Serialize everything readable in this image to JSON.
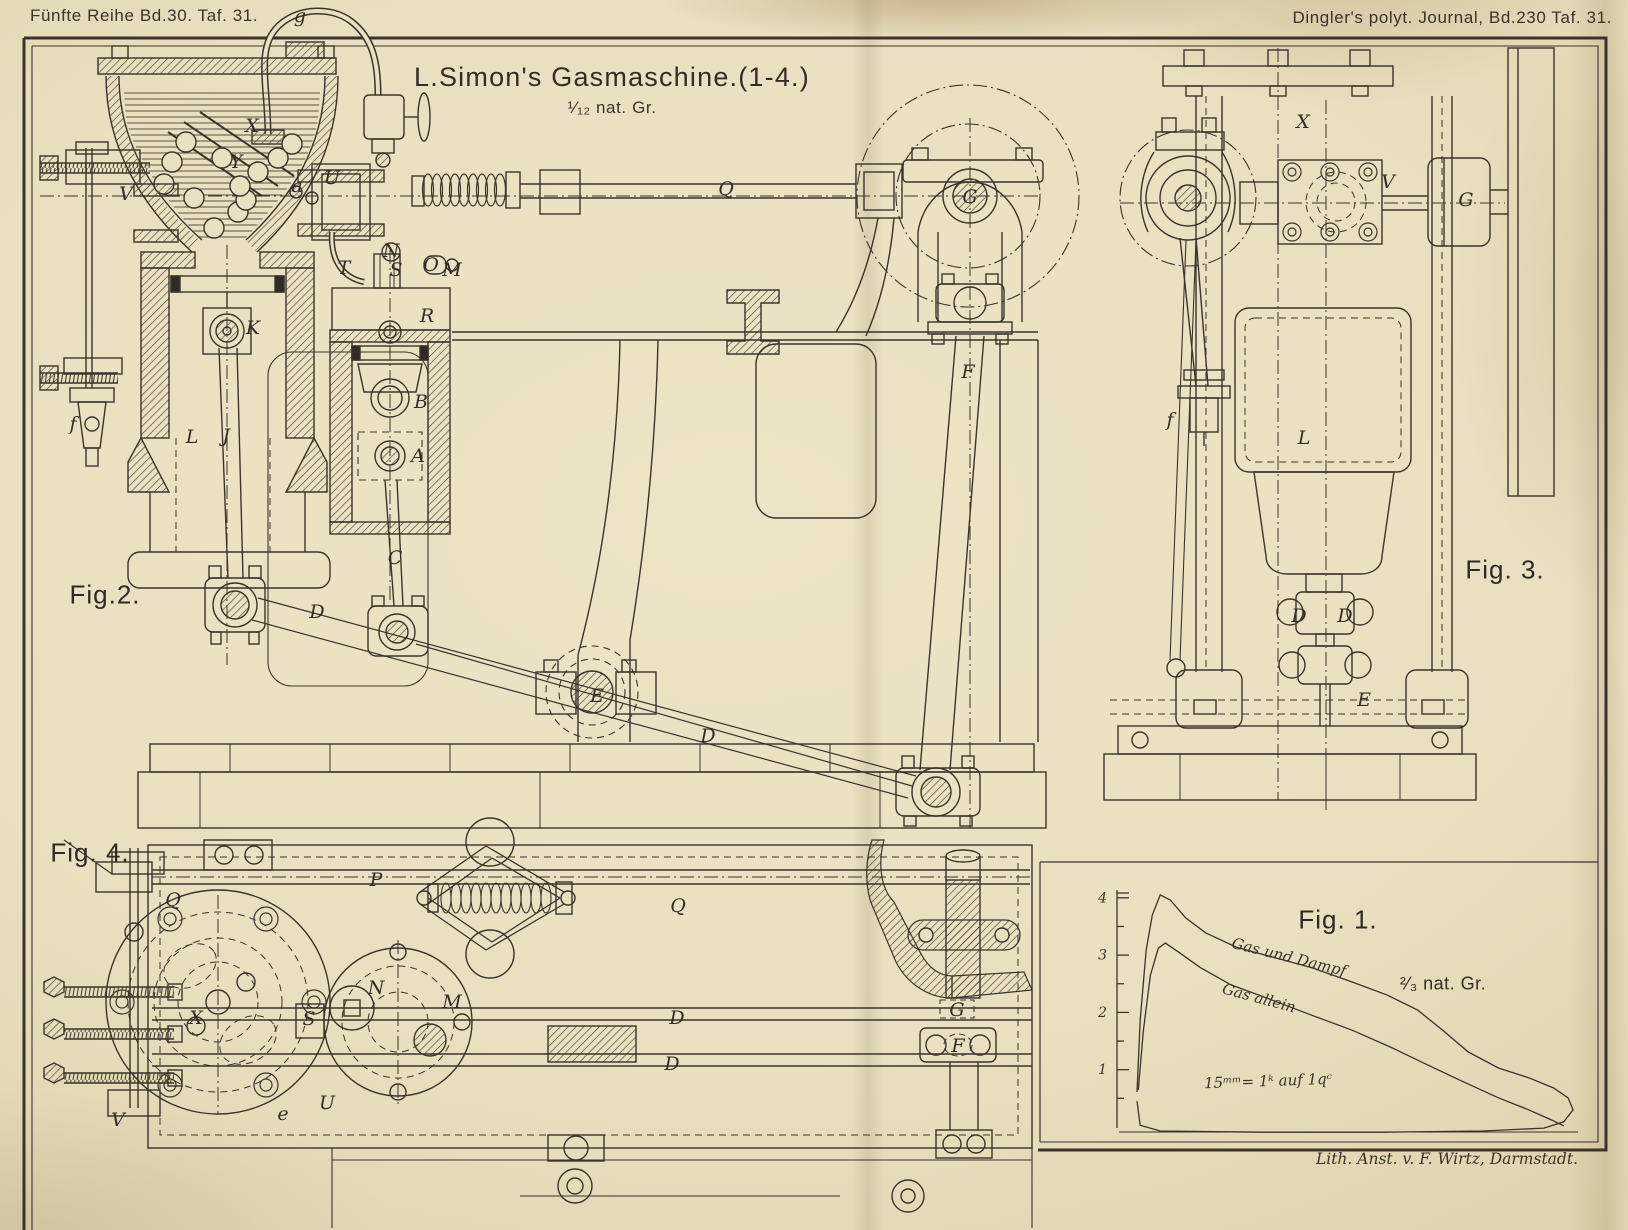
{
  "plate": {
    "header_left": "Fünfte Reihe Bd.30. Taf. 31.",
    "header_right": "Dingler's polyt. Journal, Bd.230 Taf. 31.",
    "title": "L.Simon's Gasmaschine.(1-4.)",
    "title_scale": "¹⁄₁₂ nat. Gr.",
    "credit": "Lith. Anst. v. F. Wirtz, Darmstadt.",
    "ink_color": "#3a3429",
    "paper_color": "#e8e0c0"
  },
  "figures": [
    {
      "id": "fig1",
      "label": "Fig. 1.",
      "x": 1338,
      "y": 920
    },
    {
      "id": "fig2",
      "label": "Fig.2.",
      "x": 105,
      "y": 595
    },
    {
      "id": "fig3",
      "label": "Fig. 3.",
      "x": 1505,
      "y": 570
    },
    {
      "id": "fig4",
      "label": "Fig. 4.",
      "x": 90,
      "y": 853
    }
  ],
  "part_labels": [
    {
      "fig": "fig2",
      "t": "g",
      "x": 300,
      "y": 16
    },
    {
      "fig": "fig2",
      "t": "X",
      "x": 252,
      "y": 126
    },
    {
      "fig": "fig2",
      "t": "Y",
      "x": 236,
      "y": 162
    },
    {
      "fig": "fig2",
      "t": "V",
      "x": 126,
      "y": 194
    },
    {
      "fig": "fig2",
      "t": "a",
      "x": 297,
      "y": 186
    },
    {
      "fig": "fig2",
      "t": "U",
      "x": 332,
      "y": 178
    },
    {
      "fig": "fig2",
      "t": "T",
      "x": 344,
      "y": 268
    },
    {
      "fig": "fig2",
      "t": "N",
      "x": 391,
      "y": 251
    },
    {
      "fig": "fig2",
      "t": "S",
      "x": 396,
      "y": 270
    },
    {
      "fig": "fig2",
      "t": "O",
      "x": 431,
      "y": 265
    },
    {
      "fig": "fig2",
      "t": "M",
      "x": 452,
      "y": 270
    },
    {
      "fig": "fig2",
      "t": "R",
      "x": 427,
      "y": 316
    },
    {
      "fig": "fig2",
      "t": "K",
      "x": 253,
      "y": 328
    },
    {
      "fig": "fig2",
      "t": "L",
      "x": 192,
      "y": 437
    },
    {
      "fig": "fig2",
      "t": "J",
      "x": 226,
      "y": 436
    },
    {
      "fig": "fig2",
      "t": "f",
      "x": 73,
      "y": 424
    },
    {
      "fig": "fig2",
      "t": "B",
      "x": 421,
      "y": 402
    },
    {
      "fig": "fig2",
      "t": "A",
      "x": 418,
      "y": 456
    },
    {
      "fig": "fig2",
      "t": "C",
      "x": 395,
      "y": 558
    },
    {
      "fig": "fig2",
      "t": "D",
      "x": 317,
      "y": 612
    },
    {
      "fig": "fig2",
      "t": "Q",
      "x": 726,
      "y": 189
    },
    {
      "fig": "fig2",
      "t": "G",
      "x": 970,
      "y": 197
    },
    {
      "fig": "fig2",
      "t": "F",
      "x": 968,
      "y": 372
    },
    {
      "fig": "fig2",
      "t": "D",
      "x": 708,
      "y": 736
    },
    {
      "fig": "fig2",
      "t": "E",
      "x": 597,
      "y": 696
    },
    {
      "fig": "fig3",
      "t": "X",
      "x": 1303,
      "y": 122
    },
    {
      "fig": "fig3",
      "t": "V",
      "x": 1388,
      "y": 182
    },
    {
      "fig": "fig3",
      "t": "G",
      "x": 1466,
      "y": 200
    },
    {
      "fig": "fig3",
      "t": "f",
      "x": 1170,
      "y": 420
    },
    {
      "fig": "fig3",
      "t": "L",
      "x": 1304,
      "y": 438
    },
    {
      "fig": "fig3",
      "t": "D",
      "x": 1299,
      "y": 616
    },
    {
      "fig": "fig3",
      "t": "D",
      "x": 1345,
      "y": 616
    },
    {
      "fig": "fig3",
      "t": "E",
      "x": 1364,
      "y": 700
    },
    {
      "fig": "fig4",
      "t": "P",
      "x": 376,
      "y": 880
    },
    {
      "fig": "fig4",
      "t": "Q",
      "x": 173,
      "y": 900
    },
    {
      "fig": "fig4",
      "t": "Q",
      "x": 678,
      "y": 906
    },
    {
      "fig": "fig4",
      "t": "X",
      "x": 196,
      "y": 1018
    },
    {
      "fig": "fig4",
      "t": "S",
      "x": 309,
      "y": 1019
    },
    {
      "fig": "fig4",
      "t": "N",
      "x": 376,
      "y": 988
    },
    {
      "fig": "fig4",
      "t": "M",
      "x": 452,
      "y": 1002
    },
    {
      "fig": "fig4",
      "t": "e",
      "x": 283,
      "y": 1114
    },
    {
      "fig": "fig4",
      "t": "U",
      "x": 327,
      "y": 1103
    },
    {
      "fig": "fig4",
      "t": "V",
      "x": 118,
      "y": 1120
    },
    {
      "fig": "fig4",
      "t": "D",
      "x": 677,
      "y": 1018
    },
    {
      "fig": "fig4",
      "t": "D",
      "x": 672,
      "y": 1064
    },
    {
      "fig": "fig4",
      "t": "G",
      "x": 957,
      "y": 1010
    },
    {
      "fig": "fig4",
      "t": "F",
      "x": 958,
      "y": 1046
    }
  ],
  "chart_data": {
    "type": "line",
    "title": "Fig. 1.",
    "scale_note": "²⁄₃ nat. Gr.",
    "pressure_scale_note": "15ᵐᵐ= 1ᵏ auf 1qᶜ",
    "xlabel": "",
    "ylabel": "",
    "yticks": [
      1,
      2,
      3,
      4
    ],
    "ylim": [
      -0.2,
      4.3
    ],
    "x_unit": "percent of stroke",
    "legend_position": "on-curve",
    "grid": false,
    "series": [
      {
        "name": "Gas und Dampf",
        "points": [
          [
            4.3,
            0.61
          ],
          [
            5,
            1.87
          ],
          [
            6.3,
            3.09
          ],
          [
            7.6,
            3.7
          ],
          [
            9.3,
            4.05
          ],
          [
            11.5,
            3.96
          ],
          [
            14.8,
            3.65
          ],
          [
            19.1,
            3.39
          ],
          [
            25.7,
            3.14
          ],
          [
            33.3,
            2.97
          ],
          [
            42,
            2.78
          ],
          [
            50.7,
            2.53
          ],
          [
            58.3,
            2.3
          ],
          [
            64.8,
            2.04
          ],
          [
            70.2,
            1.69
          ],
          [
            75.7,
            1.31
          ],
          [
            82.2,
            1.03
          ],
          [
            88.7,
            0.86
          ],
          [
            94.1,
            0.68
          ],
          [
            97.2,
            0.51
          ],
          [
            98.3,
            0.3
          ],
          [
            96.3,
            0.09
          ],
          [
            92,
            -0.02
          ],
          [
            78.9,
            -0.07
          ],
          [
            57.2,
            -0.09
          ],
          [
            31.1,
            -0.09
          ],
          [
            9.3,
            -0.07
          ],
          [
            5,
            0.03
          ],
          [
            4.3,
            0.45
          ]
        ]
      },
      {
        "name": "Gas allein",
        "points": [
          [
            4.6,
            0.65
          ],
          [
            5.7,
            1.69
          ],
          [
            7.2,
            2.65
          ],
          [
            8.9,
            3.12
          ],
          [
            10.4,
            3.21
          ],
          [
            13.3,
            3.05
          ],
          [
            18,
            2.78
          ],
          [
            24.6,
            2.48
          ],
          [
            33.3,
            2.22
          ],
          [
            42,
            1.95
          ],
          [
            50.7,
            1.69
          ],
          [
            59.3,
            1.38
          ],
          [
            67,
            1.08
          ],
          [
            74.6,
            0.79
          ],
          [
            82.2,
            0.51
          ],
          [
            88.7,
            0.3
          ],
          [
            93.7,
            0.12
          ],
          [
            96.3,
            0.02
          ]
        ]
      }
    ],
    "baseline_pressure": 0
  }
}
